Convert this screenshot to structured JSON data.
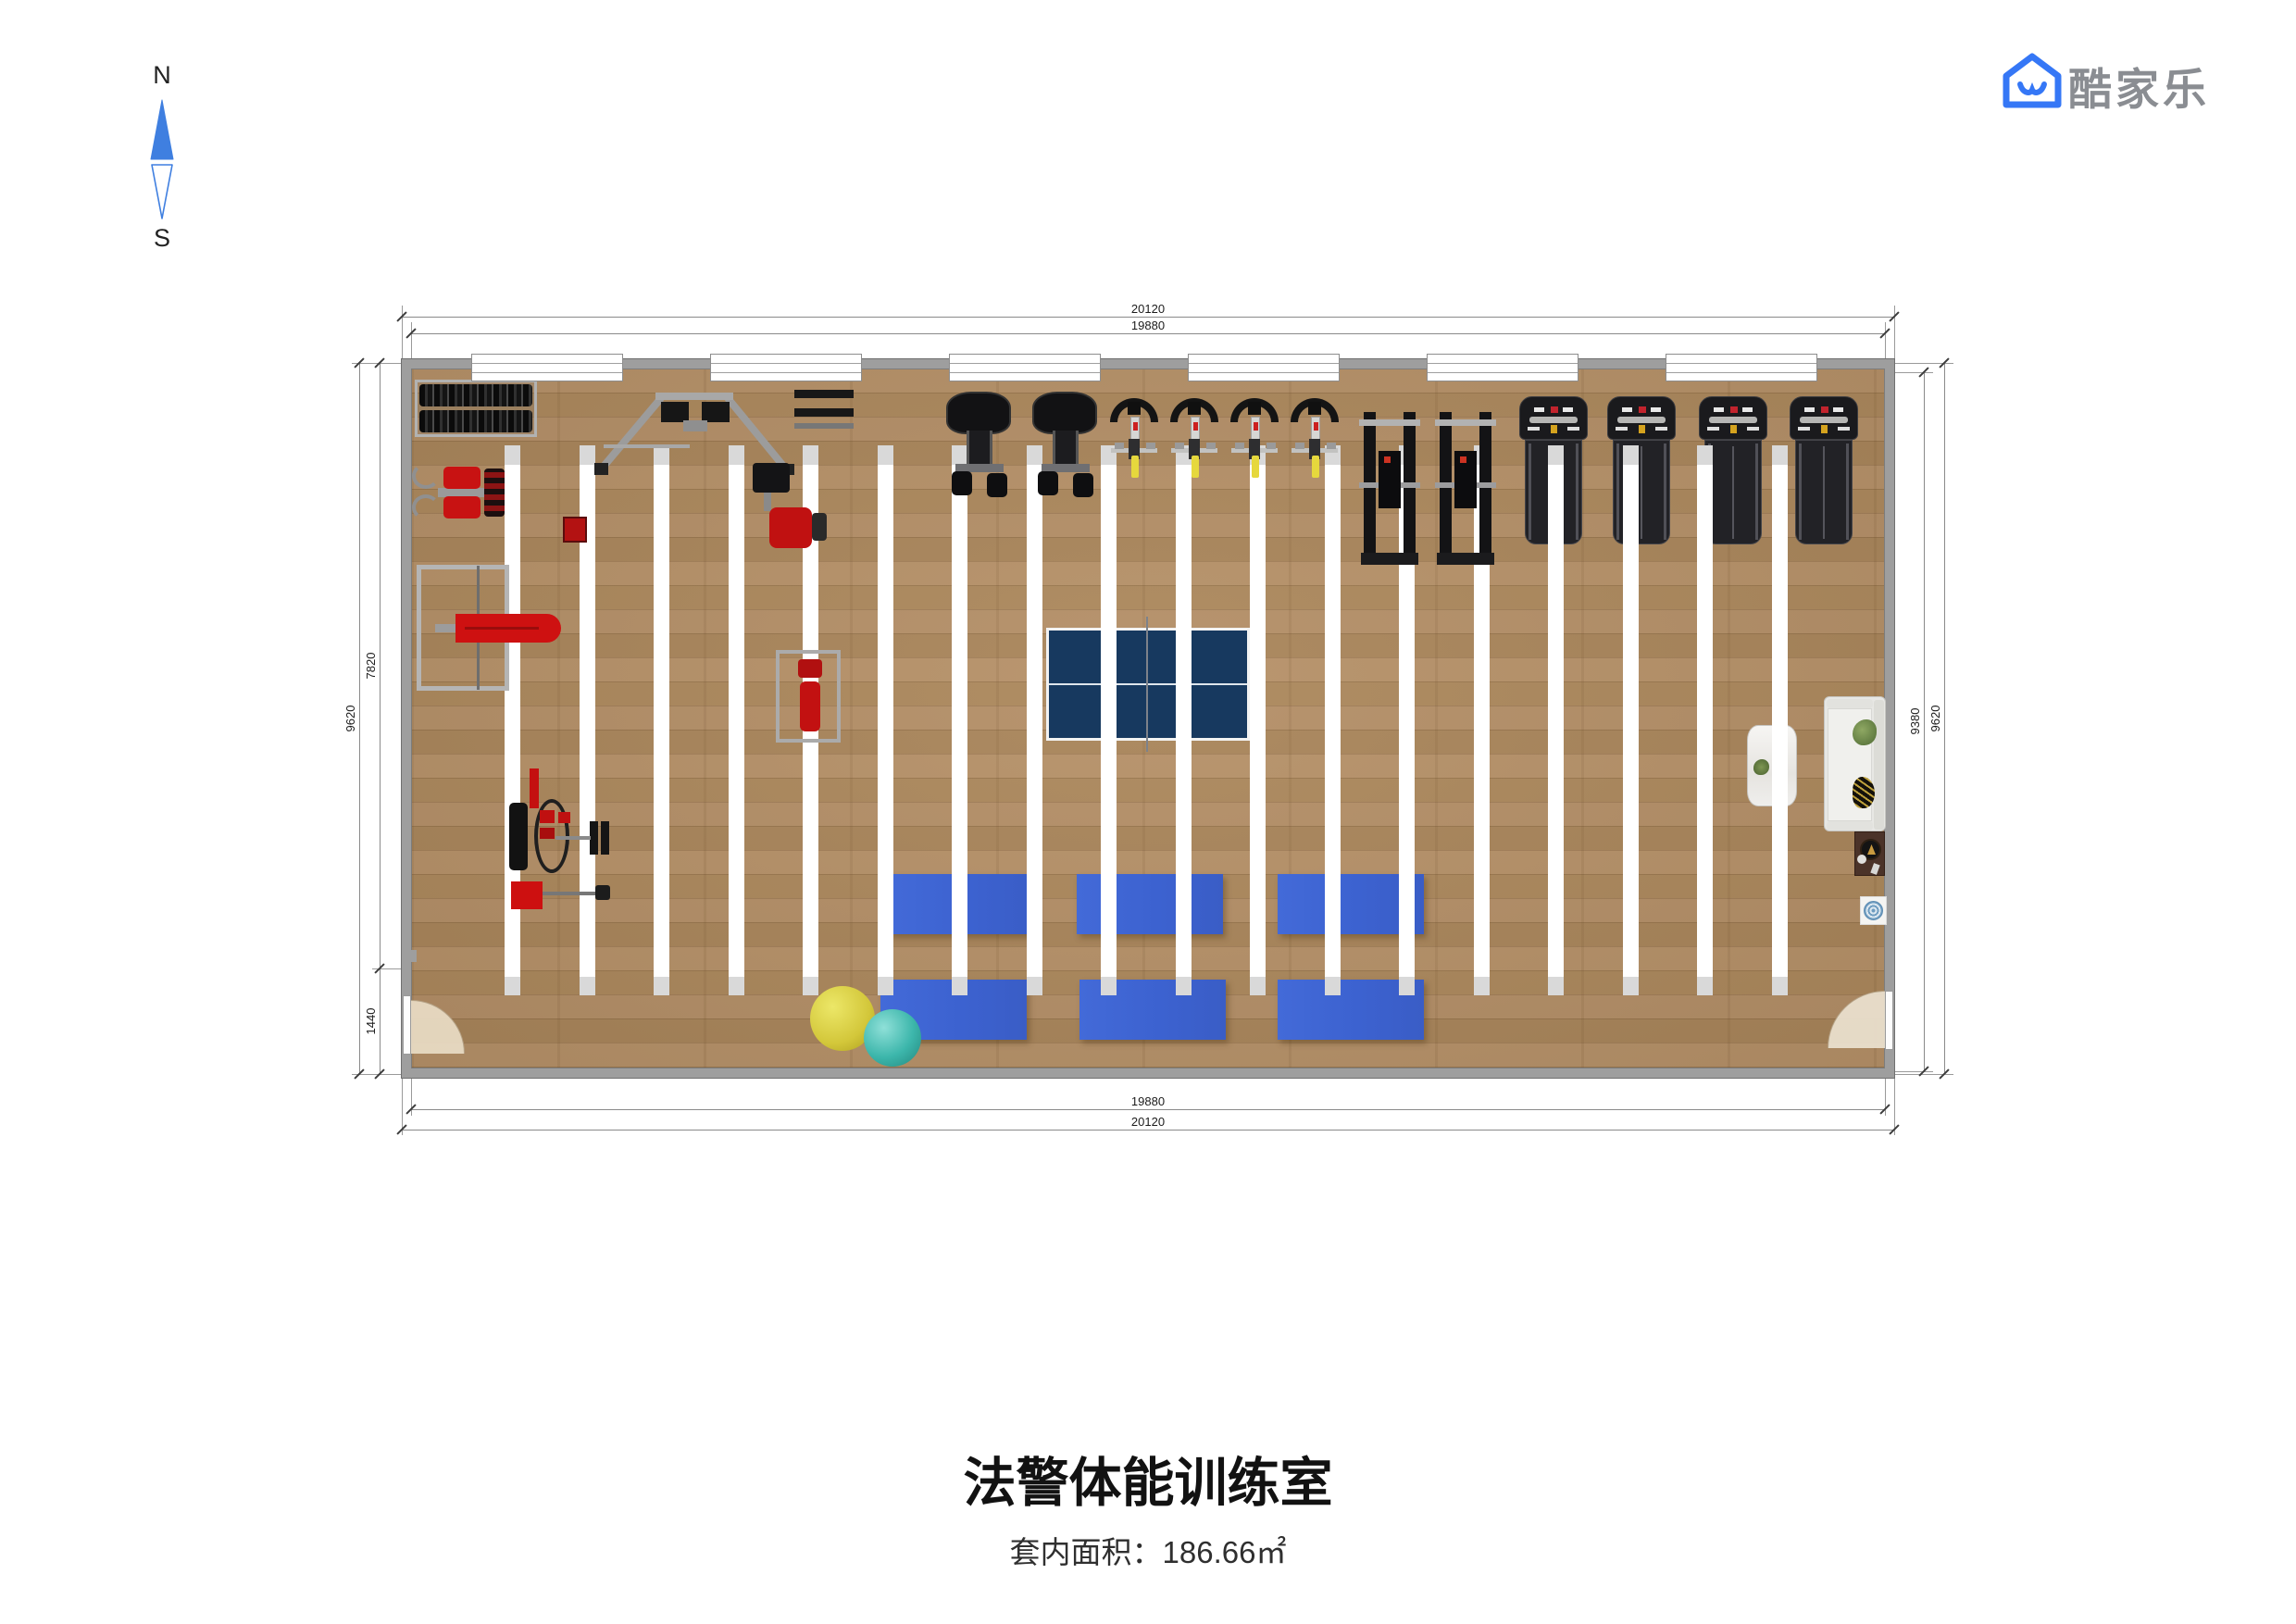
{
  "compass": {
    "north": "N",
    "south": "S"
  },
  "logo": {
    "text": "酷家乐",
    "icon": "kujiale-house-smile-icon",
    "icon_color": "#3577F6",
    "text_color": "#8A8D92"
  },
  "dimensions": {
    "top": [
      "20120",
      "19880"
    ],
    "bottom": [
      "19880",
      "20120"
    ],
    "left": [
      "9620",
      "7820",
      "1440"
    ],
    "right": [
      "9380",
      "9620"
    ]
  },
  "footer": {
    "title": "法警体能训练室",
    "area": "套内面积：186.66㎡"
  },
  "plan": {
    "lane_count": 18,
    "window_count": 6,
    "treadmill_count": 4,
    "spin_bike_count": 4,
    "elliptical_count": 2,
    "multi_station_count": 2,
    "mat_count": 6,
    "door_count": 2,
    "colors": {
      "floor_wood": "#b28e60",
      "wall_gray": "#9e9e9e",
      "lane_white": "#ffffff",
      "lane_cap": "#d9d9d9",
      "mat_blue": "#3c62d0",
      "table_tennis_navy": "#173a5f",
      "equipment_red": "#c41212",
      "equipment_black": "#141416",
      "ball_yellow": "#d5c93c",
      "ball_teal": "#3cb6ab",
      "sofa_white": "#e7e7e4",
      "door_arc_beige": "#e9dcc6"
    },
    "equipment_legend": [
      "dumbbell-rack",
      "pec-deck-machine",
      "power-cage",
      "weight-bench",
      "cable-crossover-machine",
      "shoulder-press-machine",
      "barbell-rack",
      "bench-press-station",
      "leg-press-machine",
      "barbell-bench",
      "elliptical-machine",
      "spin-bike",
      "multi-station-machine",
      "treadmill",
      "table-tennis-table",
      "exercise-mat",
      "exercise-ball",
      "sofa",
      "console-table",
      "side-table",
      "floor-pad",
      "door"
    ]
  }
}
